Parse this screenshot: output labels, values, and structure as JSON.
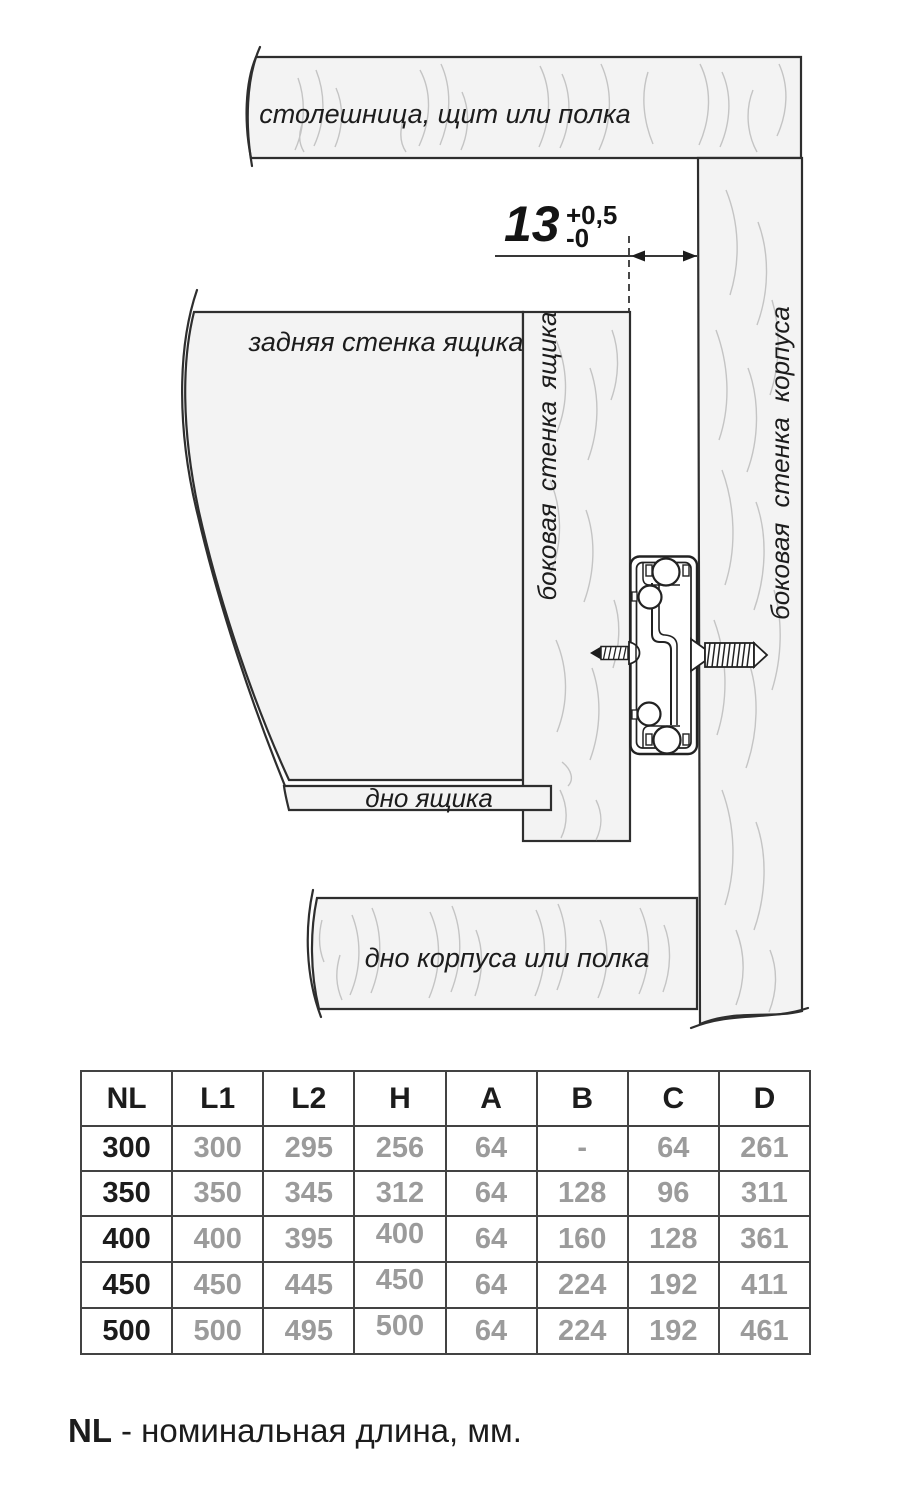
{
  "diagram": {
    "labels": {
      "top_panel": "столешница, щит или полка",
      "back_wall": "задняя стенка ящика",
      "drawer_side_wall": "боковая стенка ящика",
      "cabinet_side_wall": "боковая стенка корпуса",
      "drawer_bottom": "дно ящика",
      "cabinet_bottom": "дно корпуса или полка"
    },
    "dimension": {
      "value": "13",
      "tolerance_plus": "+0,5",
      "tolerance_minus": "-0"
    }
  },
  "table": {
    "headers": [
      "NL",
      "L1",
      "L2",
      "H",
      "A",
      "B",
      "C",
      "D"
    ],
    "rows": [
      [
        "300",
        "300",
        "295",
        "256",
        "64",
        "-",
        "64",
        "261"
      ],
      [
        "350",
        "350",
        "345",
        "312",
        "64",
        "128",
        "96",
        "311"
      ],
      [
        "400",
        "400",
        "395",
        "400",
        "64",
        "160",
        "128",
        "361"
      ],
      [
        "450",
        "450",
        "445",
        "450",
        "64",
        "224",
        "192",
        "411"
      ],
      [
        "500",
        "500",
        "495",
        "500",
        "64",
        "224",
        "192",
        "461"
      ]
    ]
  },
  "footnote": {
    "term": "NL",
    "definition": "- номинальная длина, мм."
  },
  "colors": {
    "panel_fill": "#f3f3f3",
    "outline": "#2e2e2e",
    "grain": "#c4c4c4",
    "table_border": "#434343",
    "text": "#1c1c1c",
    "muted_value": "#9b9b9b"
  }
}
